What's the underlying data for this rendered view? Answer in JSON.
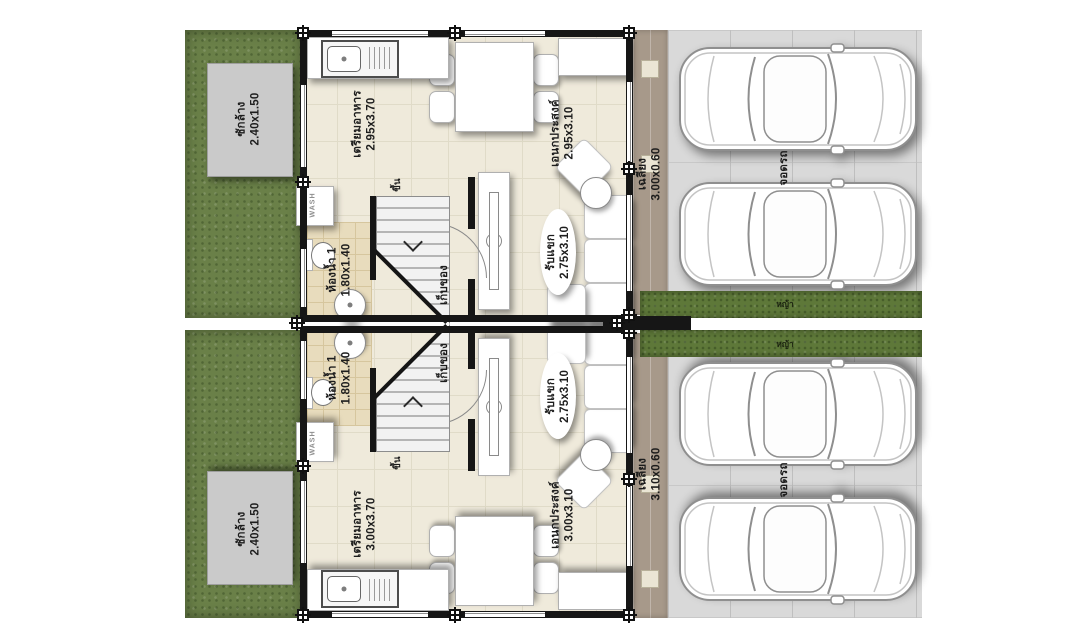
{
  "plan": {
    "type": "duplex-townhouse-ground-floor-plan",
    "colors": {
      "lawn": "#6a8048",
      "grass_strip": "#5e7839",
      "house_floor": "#efeadb",
      "bath_floor": "#e8dcbd",
      "terrace": "#a7998a",
      "parking_slab": "#d9d9d9",
      "laundry_pad": "#cacaca",
      "wall": "#161616",
      "furniture": "#ffffff",
      "label_text": "#1d1d1d"
    },
    "units": [
      {
        "id": "upper-unit",
        "laundry": {
          "name": "ซักล้าง",
          "dims": "2.40x1.50"
        },
        "kitchen": {
          "name": "เตรียมอาหาร",
          "dims": "2.95x3.70"
        },
        "multipurpose": {
          "name": "เอนกประสงค์",
          "dims": "2.95x3.10"
        },
        "bathroom": {
          "name": "ห้องน้ำ 1",
          "dims": "1.80x1.40"
        },
        "storage": {
          "name": "เก็บของ"
        },
        "stairs_up": {
          "name": "ขึ้น"
        },
        "living": {
          "name": "รับแขก",
          "dims": "2.75x3.10"
        },
        "terrace": {
          "name": "เฉลียง",
          "dims": "3.00x0.60"
        },
        "parking": {
          "name": "จอดรถ"
        },
        "grass_strip": {
          "name": "หญ้า"
        },
        "washer": {
          "label": "WASH"
        }
      },
      {
        "id": "lower-unit",
        "laundry": {
          "name": "ซักล้าง",
          "dims": "2.40x1.50"
        },
        "kitchen": {
          "name": "เตรียมอาหาร",
          "dims": "3.00x3.70"
        },
        "multipurpose": {
          "name": "เอนกประสงค์",
          "dims": "3.00x3.10"
        },
        "bathroom": {
          "name": "ห้องน้ำ 1",
          "dims": "1.80x1.40"
        },
        "storage": {
          "name": "เก็บของ"
        },
        "stairs_up": {
          "name": "ขึ้น"
        },
        "living": {
          "name": "รับแขก",
          "dims": "2.75x3.10"
        },
        "terrace": {
          "name": "เฉลียง",
          "dims": "3.10x0.60"
        },
        "parking": {
          "name": "จอดรถ"
        },
        "grass_strip": {
          "name": "หญ้า"
        },
        "washer": {
          "label": "WASH"
        }
      }
    ]
  }
}
